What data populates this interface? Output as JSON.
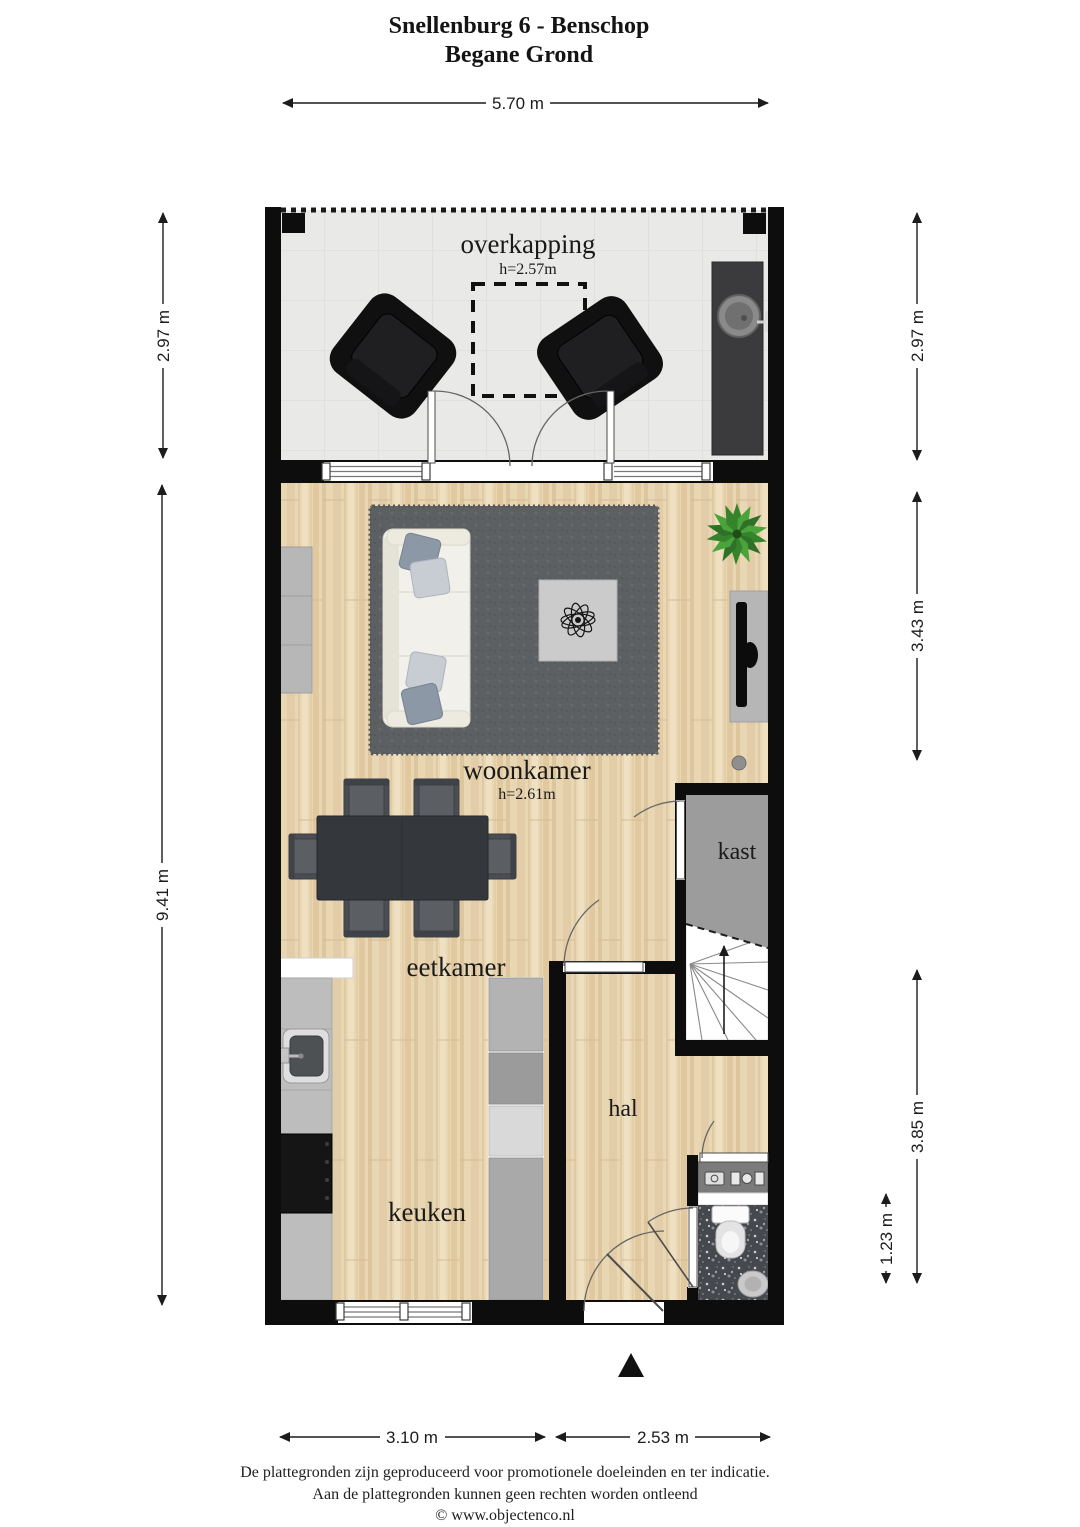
{
  "title": {
    "line1": "Snellenburg 6 - Benschop",
    "line2": "Begane Grond"
  },
  "rooms": {
    "overkapping": {
      "label": "overkapping",
      "ceiling_height": "h=2.57m"
    },
    "woonkamer": {
      "label": "woonkamer",
      "ceiling_height": "h=2.61m"
    },
    "kast": {
      "label": "kast"
    },
    "eetkamer": {
      "label": "eetkamer"
    },
    "hal": {
      "label": "hal"
    },
    "keuken": {
      "label": "keuken"
    }
  },
  "dimensions": {
    "top_width": "5.70 m",
    "terrace_height_left": "2.97 m",
    "main_height_left": "9.41 m",
    "terrace_height_right": "2.97 m",
    "livingroom_height_right": "3.43 m",
    "hall_height_right": "3.85 m",
    "toilet_height_right": "1.23 m",
    "bottom_left_width": "3.10 m",
    "bottom_right_width": "2.53 m"
  },
  "footer": {
    "line1": "De plattegronden zijn geproduceerd voor promotionele doeleinden en ter indicatie.",
    "line2": "Aan de plattegronden kunnen geen rechten worden ontleend",
    "line3": "© www.objectenco.nl"
  },
  "colors": {
    "wall": "#0d0d0d",
    "wood_floor": "#e9d6b3",
    "terrace_floor": "#e9e9e7",
    "rug": "#5d6063",
    "kast_floor": "#9c9c9c",
    "toilet_floor": "#45494e",
    "counter": "#bdbdbd",
    "dining_set": "#34383d",
    "plant_green": "#3f8f33",
    "dimension_line": "#1c1c1c"
  }
}
